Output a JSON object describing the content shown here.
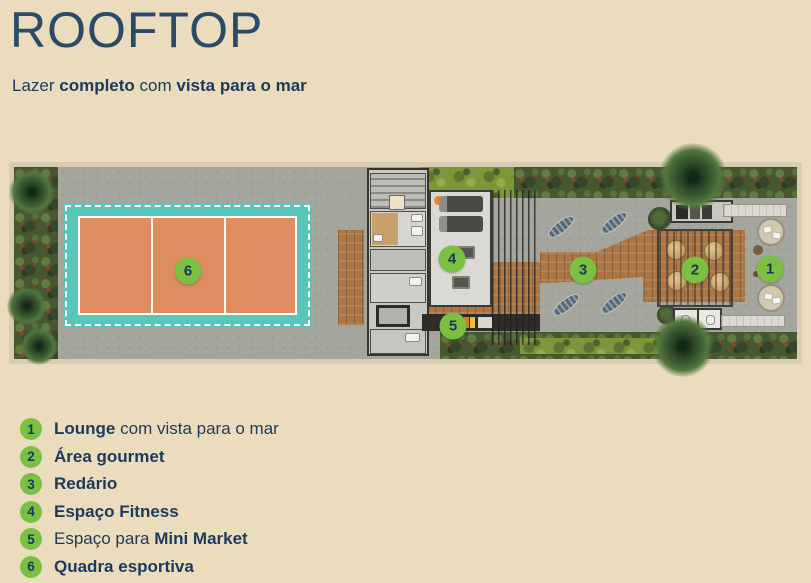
{
  "header": {
    "title": "ROOFTOP",
    "subtitle_parts": [
      {
        "text": "Lazer ",
        "bold": false
      },
      {
        "text": "completo",
        "bold": true
      },
      {
        "text": " com ",
        "bold": false
      },
      {
        "text": "vista para o mar",
        "bold": true
      }
    ]
  },
  "plan": {
    "markers": [
      {
        "num": "1",
        "x": 761,
        "y": 107
      },
      {
        "num": "2",
        "x": 686,
        "y": 108
      },
      {
        "num": "3",
        "x": 574,
        "y": 108
      },
      {
        "num": "4",
        "x": 443,
        "y": 97
      },
      {
        "num": "5",
        "x": 444,
        "y": 164
      },
      {
        "num": "6",
        "x": 179,
        "y": 109
      }
    ]
  },
  "legend": {
    "items": [
      {
        "num": "1",
        "parts": [
          {
            "text": "Lounge",
            "bold": true
          },
          {
            "text": " com vista para o mar",
            "bold": false
          }
        ]
      },
      {
        "num": "2",
        "parts": [
          {
            "text": "Área gourmet",
            "bold": true
          }
        ]
      },
      {
        "num": "3",
        "parts": [
          {
            "text": "Redário",
            "bold": true
          }
        ]
      },
      {
        "num": "4",
        "parts": [
          {
            "text": "Espaço Fitness",
            "bold": true
          }
        ]
      },
      {
        "num": "5",
        "parts": [
          {
            "text": "Espaço para ",
            "bold": false
          },
          {
            "text": "Mini Market",
            "bold": true
          }
        ]
      },
      {
        "num": "6",
        "parts": [
          {
            "text": "Quadra esportiva",
            "bold": true
          }
        ]
      }
    ]
  },
  "colors": {
    "background": "#eadcbd",
    "navy": "#1c3a5c",
    "accent_green": "#7bc043",
    "court_teal": "#58c6ba",
    "court_clay": "#dd8d60",
    "deck_wood": "#ab7544",
    "concrete": "#a4a59d"
  }
}
